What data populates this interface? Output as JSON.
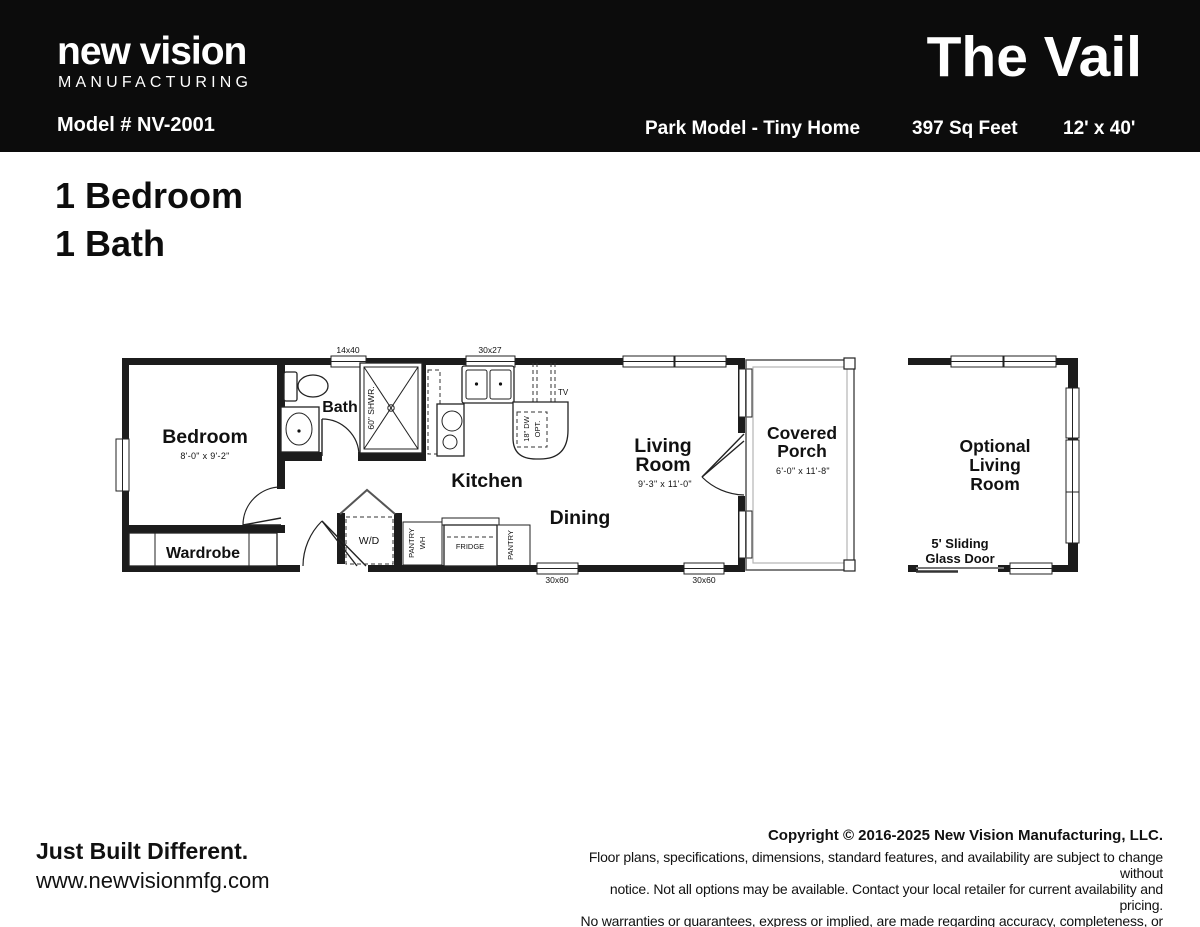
{
  "colors": {
    "header_bg": "#0c0c0c",
    "text": "#111111",
    "wall": "#1c1c1c"
  },
  "header": {
    "brand_line1": "new vision",
    "brand_line2": "MANUFACTURING",
    "model": "Model # NV-2001",
    "title": "The Vail",
    "spec_type": "Park Model - Tiny Home",
    "spec_sqft": "397 Sq Feet",
    "spec_size": "12' x 40'"
  },
  "summary": {
    "bedrooms": "1 Bedroom",
    "baths": "1 Bath"
  },
  "plan": {
    "windows": {
      "w_14x40": "14x40",
      "w_30x27": "30x27",
      "w_30x60_a": "30x60",
      "w_30x60_b": "30x60"
    },
    "bedroom": {
      "label": "Bedroom",
      "dims": "8'-0\" x 9'-2\""
    },
    "wardrobe_label": "Wardrobe",
    "bath_label": "Bath",
    "shower_label": "60\" SHWR.",
    "kitchen_label": "Kitchen",
    "dining_label": "Dining",
    "living": {
      "line1": "Living",
      "line2": "Room",
      "dims": "9'-3\" x 11'-0\""
    },
    "porch": {
      "line1": "Covered",
      "line2": "Porch",
      "dims": "6'-0\" x 11'-8\""
    },
    "optional": {
      "line1": "Optional",
      "line2": "Living",
      "line3": "Room"
    },
    "sliding_door": {
      "line1": "5' Sliding",
      "line2": "Glass Door"
    },
    "wd_label": "W/D",
    "pantry_wh": {
      "line1": "PANTRY",
      "line2": "WH"
    },
    "fridge_label": "FRIDGE",
    "pantry_label": "PANTRY",
    "tv_label": "TV",
    "dw": {
      "line1": "18\" DW",
      "line2": "OPT."
    }
  },
  "footer": {
    "tagline": "Just Built Different.",
    "website": "www.newvisionmfg.com",
    "copyright": "Copyright © 2016-2025 New Vision Manufacturing, LLC.",
    "disclaimer1": "Floor plans, specifications, dimensions, standard features, and availability are subject to change without",
    "disclaimer2": "notice. Not all options may be available. Contact your local retailer for current availability and pricing.",
    "disclaimer3": "No warranties or guarantees, express or implied, are made regarding accuracy, completeness, or availability."
  }
}
